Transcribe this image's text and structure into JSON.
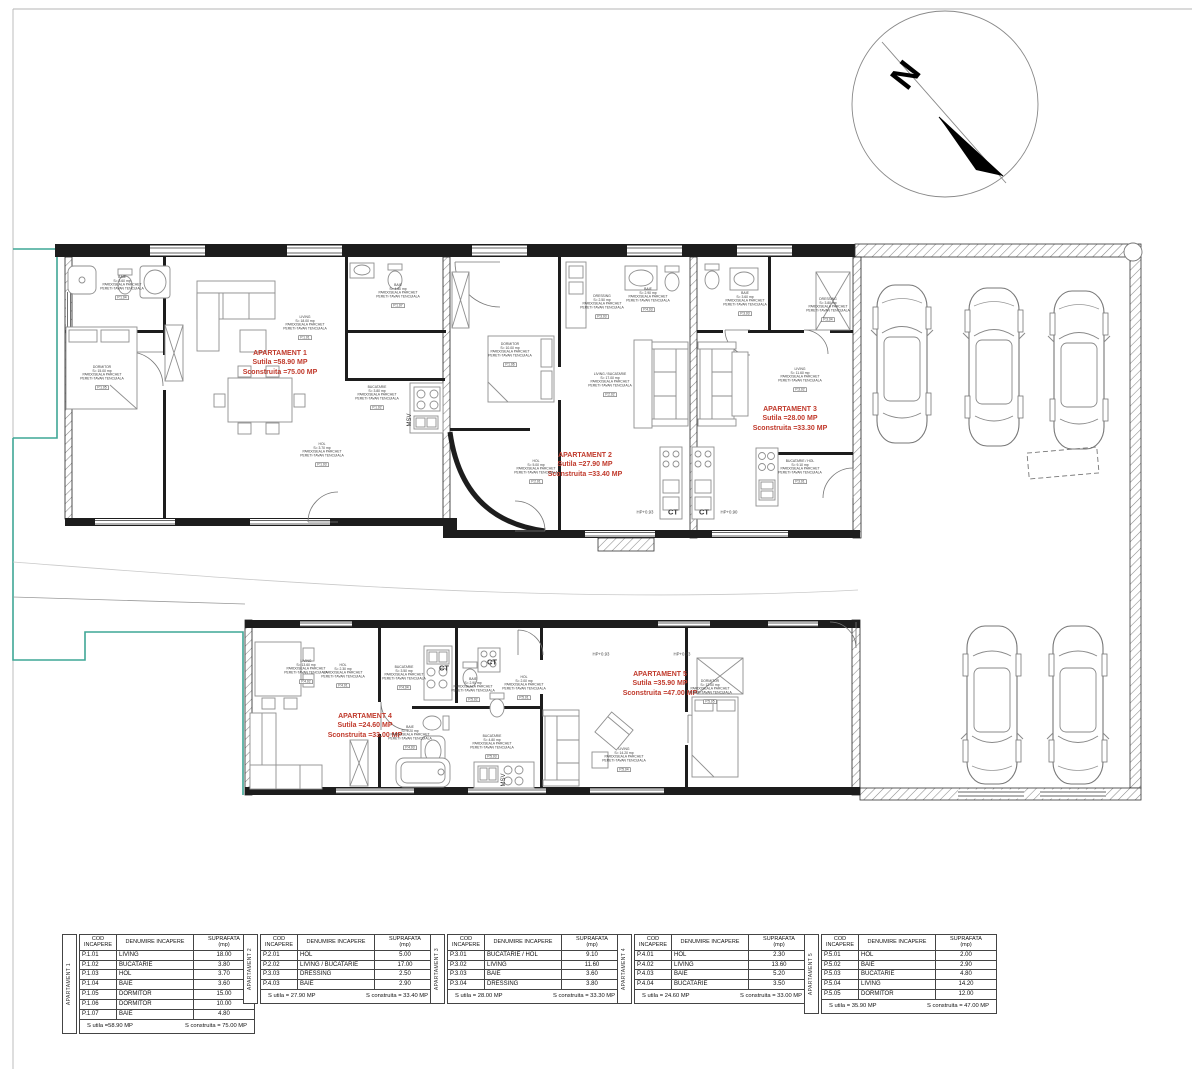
{
  "drawing": {
    "compass_label": "N",
    "apartments": [
      {
        "name": "APARTAMENT 1",
        "utila": "Sutila =58.90 MP",
        "construita": "Sconstruita =75.00 MP"
      },
      {
        "name": "APARTAMENT 2",
        "utila": "Sutila =27.90 MP",
        "construita": "Sconstruita =33.40 MP"
      },
      {
        "name": "APARTAMENT 3",
        "utila": "Sutila =28.00 MP",
        "construita": "Sconstruita =33.30 MP"
      },
      {
        "name": "APARTAMENT 4",
        "utila": "Sutila =24.60 MP",
        "construita": "Sconstruita =33.00 MP"
      },
      {
        "name": "APARTAMENT 5",
        "utila": "Sutila =35.90 MP",
        "construita": "Sconstruita =47.00 MP"
      }
    ],
    "equipment_tags": [
      "CT",
      "CT",
      "CT",
      "CT",
      "MSV",
      "MSV"
    ],
    "level_tags": [
      "HP+0.93",
      "HP+0.90",
      "HP+0.93",
      "HP+0.93"
    ],
    "finish_lines": [
      "PARDOSEALA PARCHET",
      "PERETI-TAVAN TENCUIALA"
    ],
    "room_tags": [
      {
        "name": "BAIE",
        "area": "3.60",
        "code": "P.1.04"
      },
      {
        "name": "DORMITOR",
        "area": "15.00",
        "code": "P.1.05"
      },
      {
        "name": "LIVING",
        "area": "18.00",
        "code": "P.1.01"
      },
      {
        "name": "BAIE",
        "area": "4.80",
        "code": "P.1.07"
      },
      {
        "name": "BUCATARIE",
        "area": "3.80",
        "code": "P.1.02"
      },
      {
        "name": "HOL",
        "area": "3.70",
        "code": "P.1.03"
      },
      {
        "name": "DORMITOR",
        "area": "10.00",
        "code": "P.1.06"
      },
      {
        "name": "HOL",
        "area": "5.00",
        "code": "P.2.01"
      },
      {
        "name": "DRESSING",
        "area": "2.50",
        "code": "P.3.03"
      },
      {
        "name": "BAIE",
        "area": "2.90",
        "code": "P.4.03"
      },
      {
        "name": "LIVING / BUCATARIE",
        "area": "17.00",
        "code": "P.2.02"
      },
      {
        "name": "BAIE",
        "area": "3.60",
        "code": "P.3.03"
      },
      {
        "name": "DRESSING",
        "area": "3.80",
        "code": "P.3.04"
      },
      {
        "name": "LIVING",
        "area": "11.60",
        "code": "P.3.02"
      },
      {
        "name": "BUCATARIE / HOL",
        "area": "9.10",
        "code": "P.3.01"
      },
      {
        "name": "LIVING",
        "area": "13.60",
        "code": "P.4.02"
      },
      {
        "name": "HOL",
        "area": "2.30",
        "code": "P.4.01"
      },
      {
        "name": "BUCATARIE",
        "area": "3.50",
        "code": "P.4.04"
      },
      {
        "name": "BAIE",
        "area": "5.20",
        "code": "P.4.03"
      },
      {
        "name": "BAIE",
        "area": "2.90",
        "code": "P.5.02"
      },
      {
        "name": "HOL",
        "area": "2.00",
        "code": "P.5.01"
      },
      {
        "name": "BUCATARIE",
        "area": "4.80",
        "code": "P.5.03"
      },
      {
        "name": "LIVING",
        "area": "14.20",
        "code": "P.5.04"
      },
      {
        "name": "DORMITOR",
        "area": "12.00",
        "code": "P.5.05"
      }
    ]
  },
  "tables": {
    "headers": {
      "cod": "COD INCAPERE",
      "denumire": "DENUMIRE INCAPERE",
      "suprafata": "SUPRAFATA",
      "suprafata_unit": "(mp)"
    },
    "groups": [
      {
        "side_label": "APARTAMENT 1",
        "rows": [
          [
            "P.1.01",
            "LIVING",
            "18.00"
          ],
          [
            "P.1.02",
            "BUCATARIE",
            "3.80"
          ],
          [
            "P.1.03",
            "HOL",
            "3.70"
          ],
          [
            "P.1.04",
            "BAIE",
            "3.60"
          ],
          [
            "P.1.05",
            "DORMITOR",
            "15.00"
          ],
          [
            "P.1.06",
            "DORMITOR",
            "10.00"
          ],
          [
            "P.1.07",
            "BAIE",
            "4.80"
          ]
        ],
        "s_utila": "S utila =58.90 MP",
        "s_construita": "S construita = 75.00 MP"
      },
      {
        "side_label": "APARTAMENT 2",
        "rows": [
          [
            "P.2.01",
            "HOL",
            "5.00"
          ],
          [
            "P.2.02",
            "LIVING / BUCATARIE",
            "17.00"
          ],
          [
            "P.3.03",
            "DRESSING",
            "2.50"
          ],
          [
            "P.4.03",
            "BAIE",
            "2.90"
          ]
        ],
        "s_utila": "S utila = 27.90 MP",
        "s_construita": "S construita = 33.40 MP"
      },
      {
        "side_label": "APARTAMENT 3",
        "rows": [
          [
            "P.3.01",
            "BUCATARIE / HOL",
            "9.10"
          ],
          [
            "P.3.02",
            "LIVING",
            "11.60"
          ],
          [
            "P.3.03",
            "BAIE",
            "3.60"
          ],
          [
            "P.3.04",
            "DRESSING",
            "3.80"
          ]
        ],
        "s_utila": "S utila = 28.00 MP",
        "s_construita": "S construita = 33.30 MP"
      },
      {
        "side_label": "APARTAMENT 4",
        "rows": [
          [
            "P.4.01",
            "HOL",
            "2.30"
          ],
          [
            "P.4.02",
            "LIVING",
            "13.60"
          ],
          [
            "P.4.03",
            "BAIE",
            "5.20"
          ],
          [
            "P.4.04",
            "BUCATARIE",
            "3.50"
          ]
        ],
        "s_utila": "S utila = 24.60 MP",
        "s_construita": "S construita = 33.00 MP"
      },
      {
        "side_label": "APARTAMENT 5",
        "rows": [
          [
            "P.5.01",
            "HOL",
            "2.00"
          ],
          [
            "P.5.02",
            "BAIE",
            "2.90"
          ],
          [
            "P.5.03",
            "BUCATARIE",
            "4.80"
          ],
          [
            "P.5.04",
            "LIVING",
            "14.20"
          ],
          [
            "P.5.05",
            "DORMITOR",
            "12.00"
          ]
        ],
        "s_utila": "S utila = 35.90 MP",
        "s_construita": "S construita = 47.00 MP"
      }
    ]
  },
  "colors": {
    "accent_red": "#c0392b",
    "boundary_teal": "#3fa796",
    "wall": "#1d1d1d"
  }
}
